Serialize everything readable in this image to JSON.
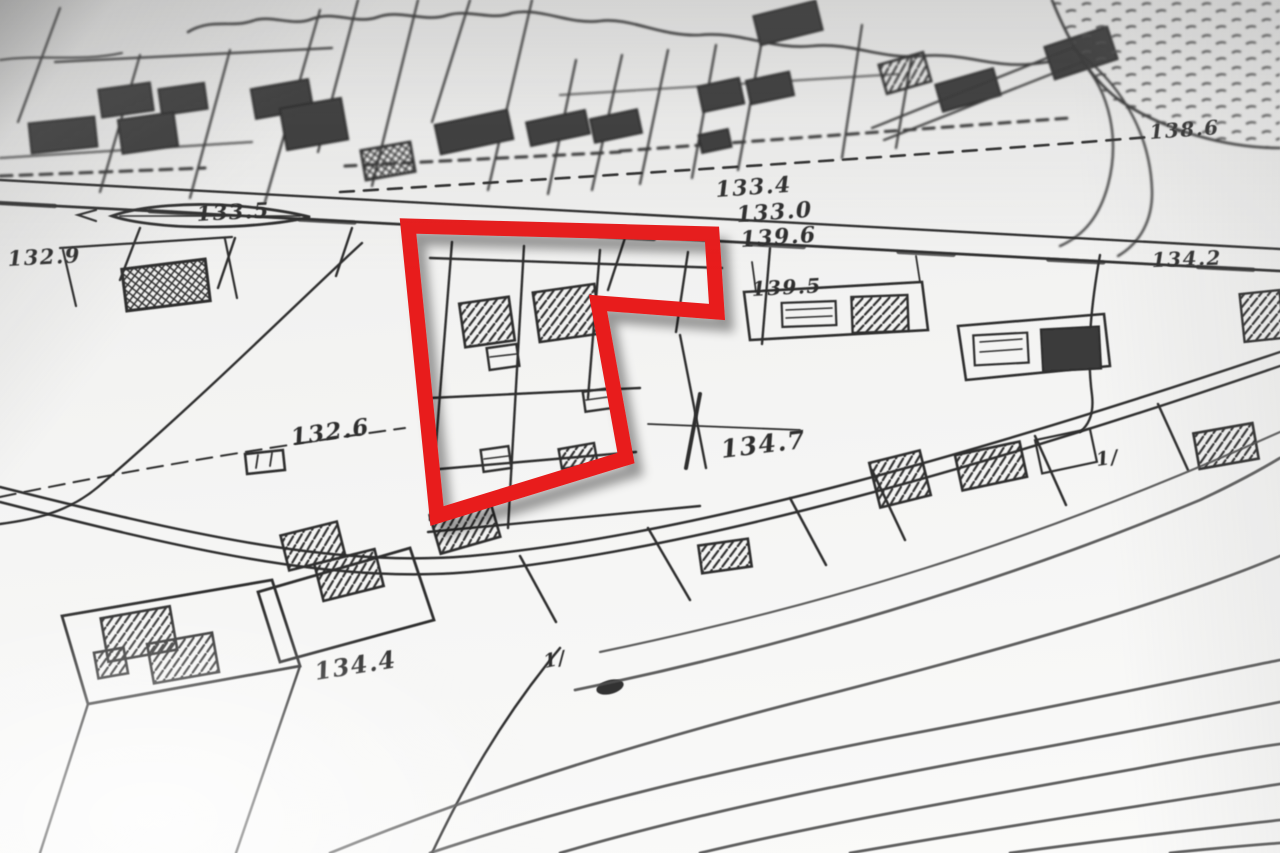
{
  "map": {
    "title": "Hand-drawn cadastral plan photograph with parcel highlighted in red",
    "colors": {
      "highlight": "#e81c1c",
      "ink": "#2e2e2e",
      "paper": "#f1f1f0"
    },
    "parcel": {
      "outline_points": "408,226 712,234 717,312 598,303 626,458 437,516"
    },
    "labels": [
      {
        "text": "133.5"
      },
      {
        "text": "132.9"
      },
      {
        "text": "133.4"
      },
      {
        "text": "133.0"
      },
      {
        "text": "139.6"
      },
      {
        "text": "139.5"
      },
      {
        "text": "138.6"
      },
      {
        "text": "134.2"
      },
      {
        "text": "132.6"
      },
      {
        "text": "134.7"
      },
      {
        "text": "134.4"
      },
      {
        "text": "1/"
      },
      {
        "text": "1/"
      }
    ]
  }
}
